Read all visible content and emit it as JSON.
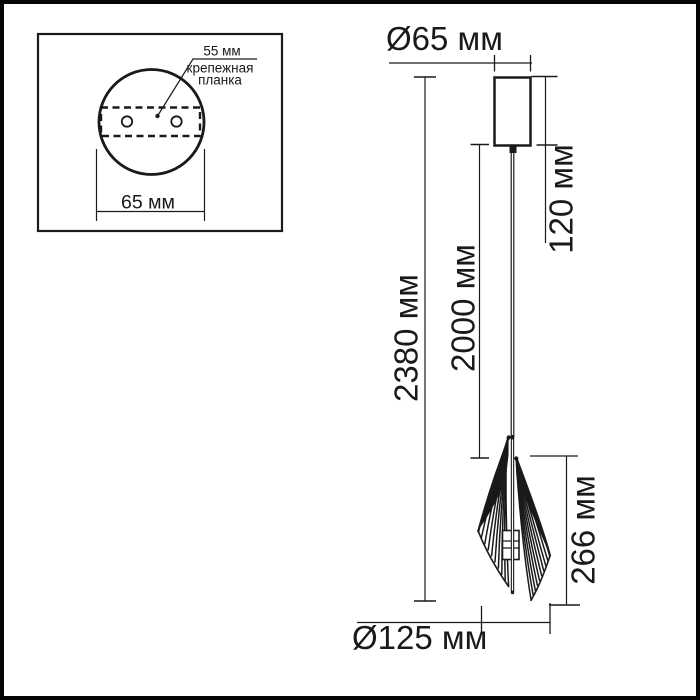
{
  "title": "Pendant lamp dimensional drawing",
  "colors": {
    "background": "#ffffff",
    "line": "#1a1a1a",
    "frame": "#050505"
  },
  "mounting_inset": {
    "bracket_width": "55 мм",
    "bracket_name_line1": "крепежная",
    "bracket_name_line2": "планка",
    "plate_width": "65 мм"
  },
  "dimensions": {
    "canopy_diameter": "Ø65 мм",
    "canopy_height": "120 мм",
    "overall_height": "2380 мм",
    "cord_length": "2000 мм",
    "shade_height": "266 мм",
    "shade_diameter": "Ø125 мм"
  }
}
